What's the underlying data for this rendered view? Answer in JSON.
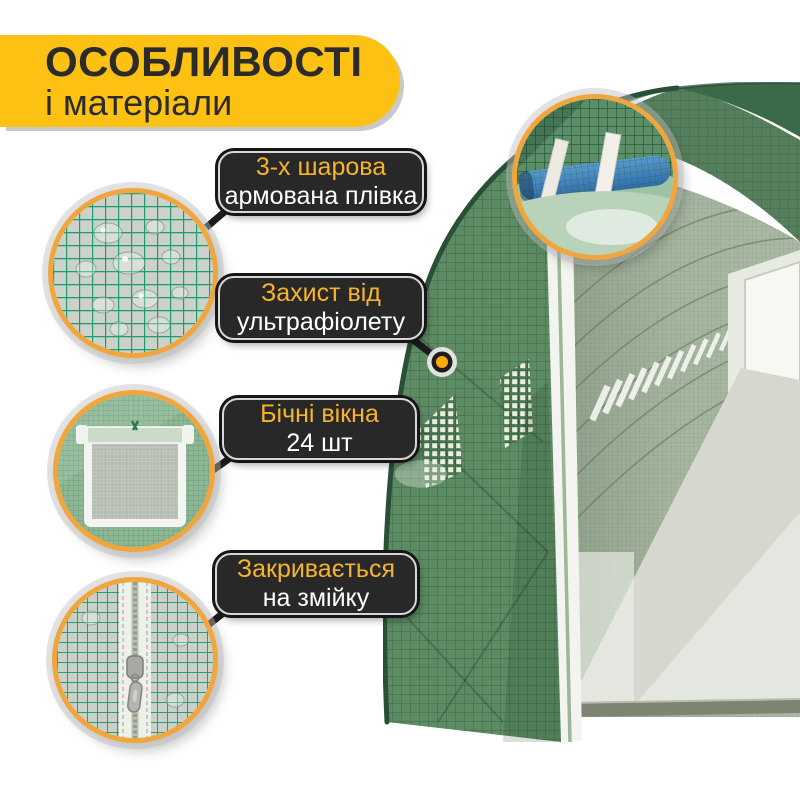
{
  "header": {
    "title": "ОСОБЛИВОСТІ",
    "subtitle": "і матеріали"
  },
  "callouts": [
    {
      "line1": "3-х шарова",
      "line2": "армована плівка"
    },
    {
      "line1": "Захист від",
      "line2": "ультрафіолету"
    },
    {
      "line1": "Бічні вікна",
      "line2": "24 шт"
    },
    {
      "line1": "Закривається",
      "line2": "на змійку"
    }
  ],
  "details": [
    "reinforced-film-droplets-photo",
    "side-window-photo",
    "zipper-photo",
    "frame-pipe-photo"
  ],
  "colors": {
    "banner_yellow": "#FCC112",
    "label_background": "#282828",
    "label_accent_text": "#F7B42B",
    "label_white_text": "#FFFFFF",
    "dot_accent": "#FFAB03",
    "circle_border_orange": "#F0A63C",
    "greenhouse_green": "#5D8B64"
  }
}
